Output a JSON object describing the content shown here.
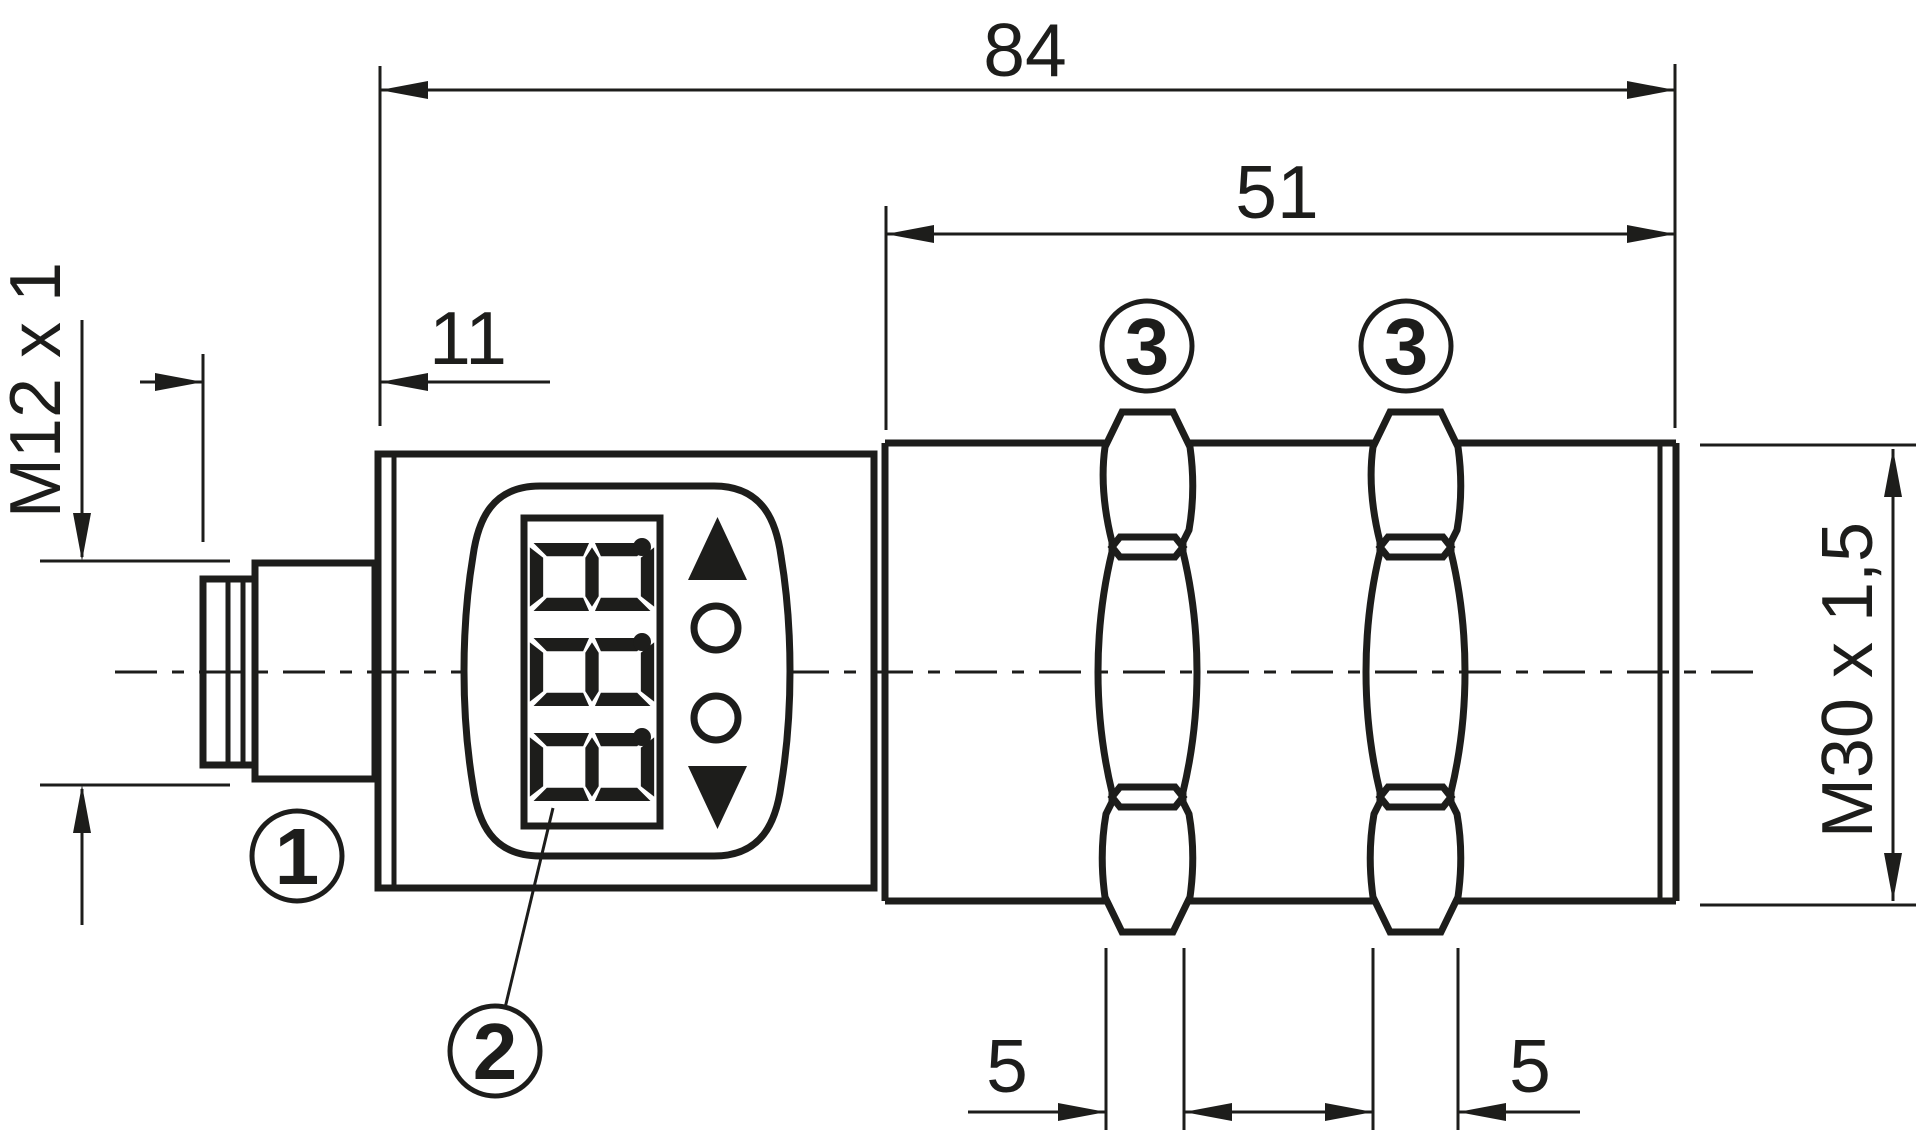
{
  "drawing": {
    "type": "sensor-dimensional-drawing",
    "units": "mm",
    "colors": {
      "ink": "#1d1d1b",
      "background": "#ffffff"
    },
    "dimensions": {
      "overall_length": "84",
      "thread_length": "51",
      "head_length": "11",
      "connector_thread": "M12 x 1",
      "body_thread": "M30 x 1,5",
      "nut1_width": "5",
      "nut2_width": "5"
    },
    "callouts": {
      "connector": "1",
      "display": "2",
      "nut1": "3",
      "nut2": "3"
    },
    "display": {
      "value": "8.8.8.",
      "digits": [
        "8",
        "8",
        "8"
      ],
      "decimal_point_after_each_digit": true,
      "buttons": [
        "up-arrow",
        "round-button",
        "round-button",
        "down-arrow"
      ]
    }
  }
}
